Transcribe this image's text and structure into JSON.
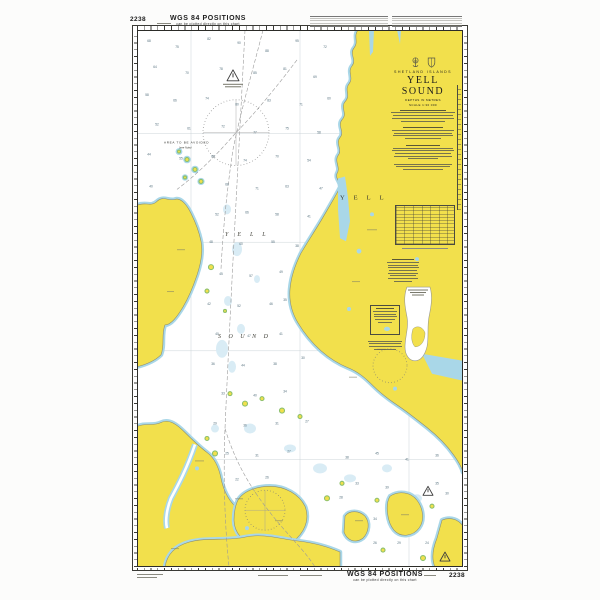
{
  "chart": {
    "number": "2238",
    "margins": {
      "top_title": "WGS 84 POSITIONS",
      "top_subtitle": "can be plotted directly on this chart",
      "bottom_title": "WGS 84 POSITIONS",
      "bottom_subtitle": "can be plotted directly on this chart",
      "top_left_number": "2238",
      "bottom_right_number": "2238"
    },
    "title_block": {
      "region": "SHETLAND ISLANDS",
      "name": "YELL SOUND",
      "depths": "DEPTHS IN METRES",
      "scale": "SCALE 1:30 000"
    },
    "map_labels": {
      "island": "YELL",
      "sound_line1": "YELL",
      "sound_line2": "SOUND",
      "caution_area": "AREA TO BE AVOIDED",
      "caution_area_note": "(see Note)"
    },
    "colors": {
      "land": "#f2e04c",
      "shallow": "#a9d7e8",
      "intertidal": "#8cc06d",
      "shoal": "#d9ecf5",
      "water": "#ffffff",
      "line": "#8b8b6f",
      "frame": "#3a3a35",
      "route": "#9a9a9a"
    },
    "soundings": [
      [
        12,
        12,
        68
      ],
      [
        40,
        18,
        75
      ],
      [
        72,
        10,
        82
      ],
      [
        102,
        14,
        90
      ],
      [
        130,
        22,
        88
      ],
      [
        160,
        12,
        95
      ],
      [
        188,
        18,
        72
      ],
      [
        18,
        38,
        64
      ],
      [
        50,
        44,
        70
      ],
      [
        84,
        40,
        78
      ],
      [
        118,
        44,
        85
      ],
      [
        148,
        40,
        81
      ],
      [
        178,
        48,
        69
      ],
      [
        10,
        66,
        58
      ],
      [
        38,
        72,
        66
      ],
      [
        70,
        70,
        74
      ],
      [
        100,
        76,
        80
      ],
      [
        132,
        72,
        83
      ],
      [
        164,
        76,
        71
      ],
      [
        192,
        70,
        60
      ],
      [
        20,
        96,
        52
      ],
      [
        52,
        100,
        61
      ],
      [
        86,
        98,
        72
      ],
      [
        118,
        104,
        77
      ],
      [
        150,
        100,
        75
      ],
      [
        182,
        104,
        58
      ],
      [
        12,
        126,
        44
      ],
      [
        44,
        130,
        55
      ],
      [
        76,
        128,
        66
      ],
      [
        108,
        132,
        74
      ],
      [
        140,
        128,
        70
      ],
      [
        172,
        132,
        54
      ],
      [
        14,
        158,
        40
      ],
      [
        90,
        156,
        68
      ],
      [
        120,
        160,
        71
      ],
      [
        150,
        158,
        63
      ],
      [
        184,
        160,
        47
      ],
      [
        80,
        186,
        52
      ],
      [
        110,
        184,
        66
      ],
      [
        140,
        186,
        58
      ],
      [
        172,
        188,
        41
      ],
      [
        74,
        214,
        48
      ],
      [
        104,
        216,
        60
      ],
      [
        136,
        214,
        55
      ],
      [
        160,
        218,
        38
      ],
      [
        84,
        246,
        45
      ],
      [
        114,
        248,
        57
      ],
      [
        144,
        244,
        49
      ],
      [
        72,
        276,
        42
      ],
      [
        102,
        278,
        52
      ],
      [
        134,
        276,
        46
      ],
      [
        148,
        272,
        35
      ],
      [
        80,
        306,
        40
      ],
      [
        112,
        308,
        47
      ],
      [
        144,
        306,
        41
      ],
      [
        76,
        336,
        36
      ],
      [
        106,
        338,
        44
      ],
      [
        138,
        336,
        38
      ],
      [
        166,
        330,
        30
      ],
      [
        86,
        366,
        33
      ],
      [
        118,
        368,
        40
      ],
      [
        148,
        364,
        34
      ],
      [
        78,
        396,
        29
      ],
      [
        108,
        398,
        36
      ],
      [
        140,
        396,
        31
      ],
      [
        170,
        394,
        27
      ],
      [
        90,
        426,
        25
      ],
      [
        120,
        428,
        31
      ],
      [
        152,
        424,
        27
      ],
      [
        100,
        452,
        22
      ],
      [
        130,
        450,
        26
      ],
      [
        210,
        430,
        38
      ],
      [
        240,
        426,
        45
      ],
      [
        270,
        432,
        41
      ],
      [
        300,
        428,
        36
      ],
      [
        220,
        456,
        33
      ],
      [
        250,
        460,
        39
      ],
      [
        300,
        456,
        35
      ],
      [
        310,
        466,
        30
      ],
      [
        204,
        470,
        28
      ],
      [
        238,
        492,
        34
      ],
      [
        238,
        516,
        26
      ],
      [
        262,
        516,
        29
      ],
      [
        290,
        516,
        24
      ]
    ]
  }
}
